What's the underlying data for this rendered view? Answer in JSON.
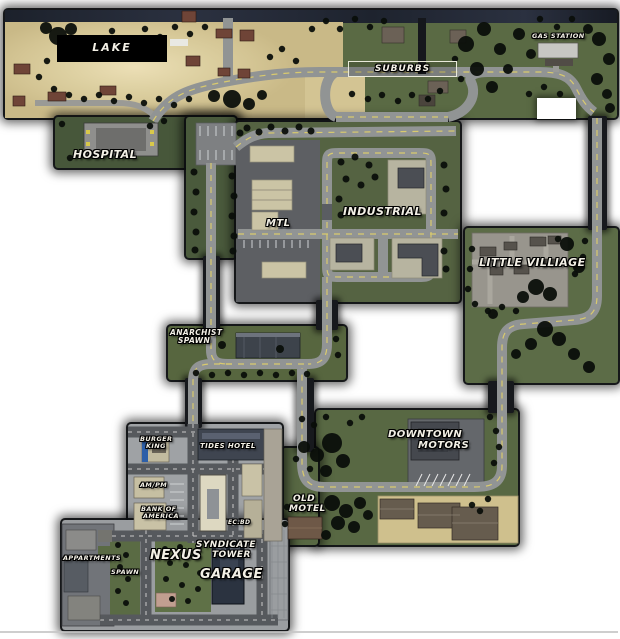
{
  "map": {
    "labels": {
      "lake": "LAKE",
      "suburbs": "SUBURBS",
      "gas_station": "GAS STATION",
      "hospital": "HOSPITAL",
      "mtl": "MTL",
      "industrial": "INDUSTRIAL",
      "little_villiage": "LITTLE VILLIAGE",
      "anarchist_spawn_line1": "ANARCHIST",
      "anarchist_spawn_line2": "SPAWN",
      "downtown_motors_line1": "DOWNTOWN",
      "downtown_motors_line2": "MOTORS",
      "old_motel_line1": "OLD",
      "old_motel_line2": "MOTEL",
      "burger_king_line1": "BURGER",
      "burger_king_line2": "KING",
      "tides_hotel": "TIDES HOTEL",
      "am_pm": "AM/PM",
      "bank_of_america_line1": "BANK OF",
      "bank_of_america_line2": "AMERICA",
      "ec_bd": "EC.BD",
      "appartments": "APPARTMENTS",
      "spawn": "SPAWN",
      "nexus": "NEXUS",
      "syndicate_tower_line1": "SYNDICATE",
      "syndicate_tower_line2": "TOWER",
      "garage": "GARAGE"
    },
    "colors": {
      "grass": "#5a6a44",
      "sand": "#d3c493",
      "rural_road": "#919494",
      "city_road": "#56595d",
      "road_center_line": "#d9ca6e",
      "tree": "#0a0e0a",
      "label_text": "#f3f0e6",
      "lake_box_bg": "#000000"
    }
  }
}
